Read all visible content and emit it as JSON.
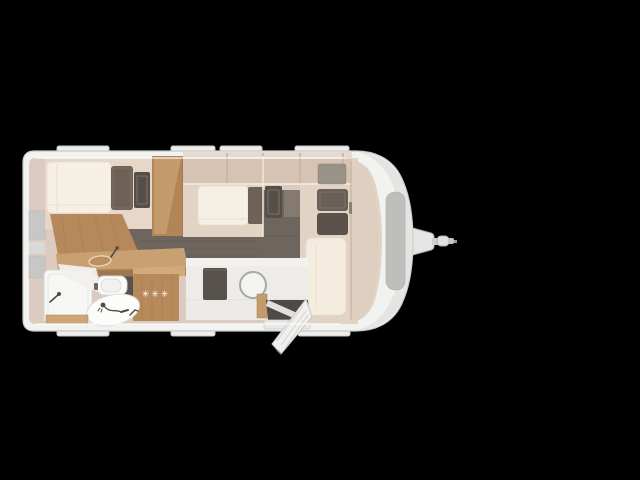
{
  "scene": {
    "background_color": "#000000",
    "subject": "top-view caravan (travel trailer) floor plan render"
  },
  "caravan": {
    "labels": {
      "fridge_stars": "✳✳✳"
    },
    "colors": {
      "body": "#f2f2f1",
      "body_outline": "#c9c9c8",
      "interior_wall": "#d9c7ba",
      "furniture_base": "#e2d3c5",
      "wood": "#c49b6d",
      "wood_dark": "#a87e52",
      "floor": "#6e655e",
      "mattress": "#f6efe3",
      "cushion_dark": "#6a5f56",
      "fixture_white": "#fafaf9",
      "hatch_gray": "#bebebd",
      "table_dark": "#57524c"
    },
    "areas": [
      {
        "name": "rear-bed"
      },
      {
        "name": "wardrobe"
      },
      {
        "name": "overhead-lockers"
      },
      {
        "name": "kitchen"
      },
      {
        "name": "refrigerator"
      },
      {
        "name": "washroom"
      },
      {
        "name": "center-bed"
      },
      {
        "name": "front-lounge-bed"
      },
      {
        "name": "dinette"
      },
      {
        "name": "entrance-door"
      },
      {
        "name": "walkway"
      },
      {
        "name": "gas-locker"
      },
      {
        "name": "tow-hitch"
      }
    ],
    "icons": [
      {
        "name": "freezer-stars-icon",
        "glyph": "✳"
      },
      {
        "name": "kitchen-faucet-icon"
      },
      {
        "name": "shower-faucet-icon"
      },
      {
        "name": "shower-head-icon"
      },
      {
        "name": "basin-faucet-icon"
      },
      {
        "name": "round-table-icon"
      },
      {
        "name": "open-door-icon"
      },
      {
        "name": "tow-coupling-icon"
      }
    ]
  }
}
